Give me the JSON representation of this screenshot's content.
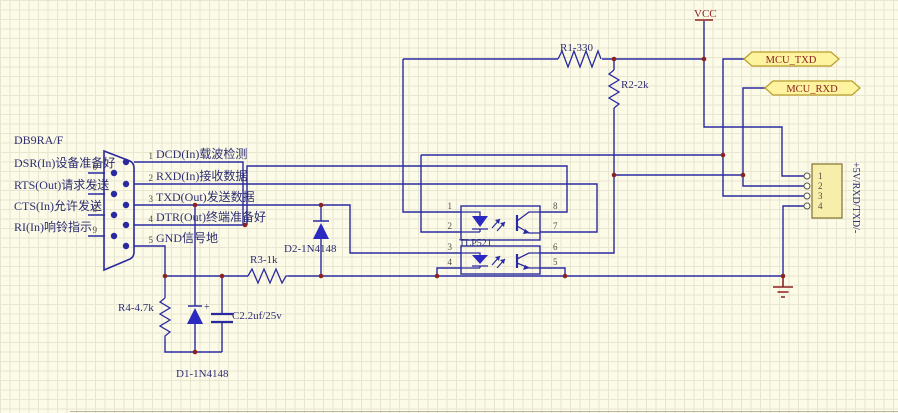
{
  "schematic": {
    "db9": {
      "title": "DB9RA/F",
      "left_pins": [
        {
          "num": "6",
          "label": "DSR(In)设备准备好"
        },
        {
          "num": "7",
          "label": "RTS(Out)请求发送"
        },
        {
          "num": "8",
          "label": "CTS(In)允许发送"
        },
        {
          "num": "9",
          "label": "RI(In)响铃指示"
        }
      ],
      "right_pins": [
        {
          "num": "1",
          "label": "DCD(In)载波检测"
        },
        {
          "num": "2",
          "label": "RXD(In)接收数据"
        },
        {
          "num": "3",
          "label": "TXD(Out)发送数据"
        },
        {
          "num": "4",
          "label": "DTR(Out)终端准备好"
        },
        {
          "num": "5",
          "label": "GND信号地"
        }
      ]
    },
    "resistors": {
      "r1": "R1-330",
      "r2": "R2-2k",
      "r3": "R3-1k",
      "r4": "R4-4.7k"
    },
    "diodes": {
      "d1": "D1-1N4148",
      "d2": "D2-1N4148"
    },
    "capacitor": {
      "label": "C2.2uf/25v",
      "plus": "+"
    },
    "optocoupler": {
      "label": "TLP521",
      "upper_pins": {
        "p1": "1",
        "p2": "2",
        "p8": "8",
        "p7": "7"
      },
      "lower_pins": {
        "p3": "3",
        "p4": "4",
        "p6": "6",
        "p5": "5"
      }
    },
    "power": {
      "vcc": "VCC"
    },
    "net_flags": {
      "txd": "MCU_TXD",
      "rxd": "MCU_RXD"
    },
    "connector": {
      "pins": [
        "1",
        "2",
        "3",
        "4"
      ],
      "side_label": "+5V/RXD/TXD/-"
    },
    "colors": {
      "wire": "#2a2aa0",
      "junction": "#8b2121",
      "power_red": "#8b2121",
      "flag_fill": "#fef39e",
      "flag_border": "#b99d2b",
      "connector_fill": "#f7eeab",
      "connector_border": "#8a7c3a",
      "text_navy": "#2e2e73",
      "background": "#fcfbe7",
      "grid": "#e8e5d0"
    }
  }
}
